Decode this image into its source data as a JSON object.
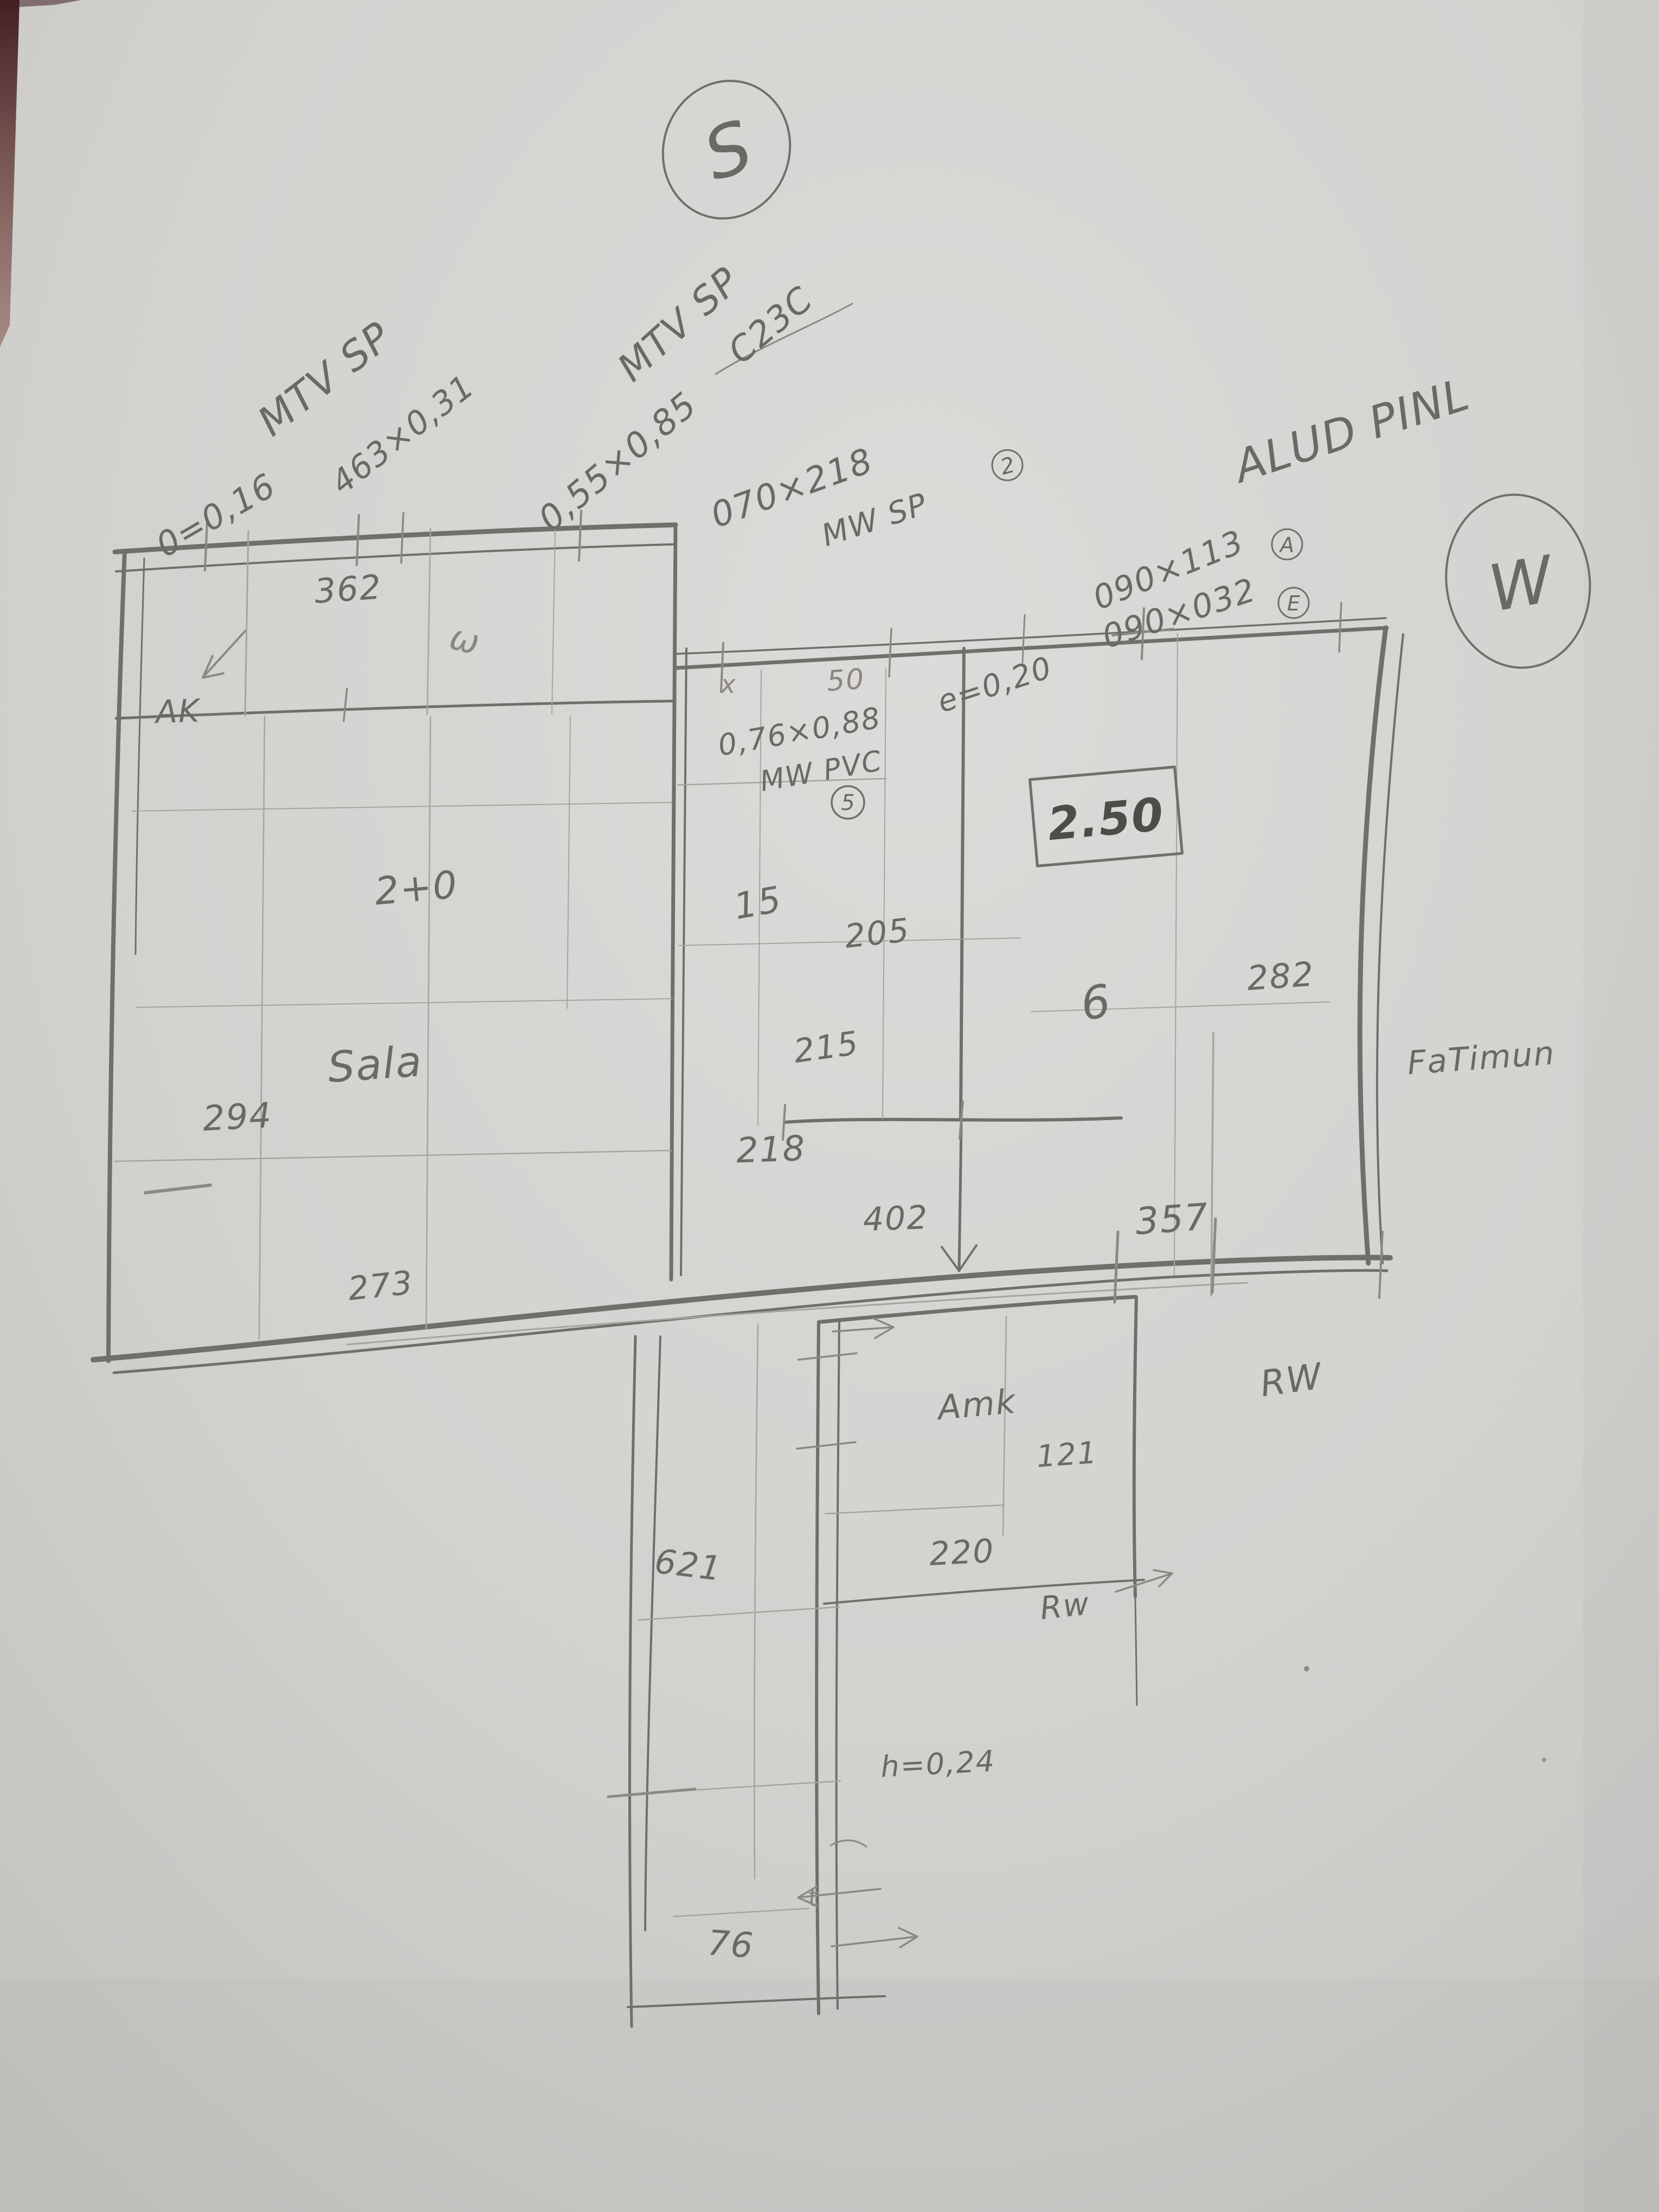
{
  "compass": {
    "south": "S",
    "west": "W"
  },
  "specs": {
    "tl1": "MTV SP",
    "tl2": "0=0,16",
    "tl3": "463×0,31",
    "tm1": "MTV SP",
    "tm2": "0,55×0,85",
    "tm3": "C23C",
    "door1": "070×218",
    "door2": "MW SP",
    "door_badge": "2",
    "e020": "e=0,20",
    "winA1": "090×113",
    "winA_badge": "A",
    "winE1": "090×032",
    "winE_badge": "E",
    "alud": "ALUD PINL",
    "win51": "0,76×0,88",
    "win52": "MW PVC",
    "win5_badge": "5",
    "fatimun": "FaTimun",
    "rw_upper": "RW",
    "rw_lower": "Rw",
    "h024": "h=0,24"
  },
  "rooms": {
    "sala": "Sala",
    "amk": "Amk"
  },
  "dims": {
    "d362": "362",
    "ak": "AK",
    "wscript": "ω",
    "d270": "2+0",
    "d294": "294",
    "d273": "273",
    "d15": "15",
    "d205": "205",
    "d215": "215",
    "d218": "218",
    "d402": "402",
    "d250": "2.50",
    "d6": "6",
    "d282": "282",
    "d357": "357",
    "d121": "121",
    "d220": "220",
    "d621": "621",
    "d76": "76",
    "x": "x",
    "d50": "50",
    "t": "t"
  }
}
